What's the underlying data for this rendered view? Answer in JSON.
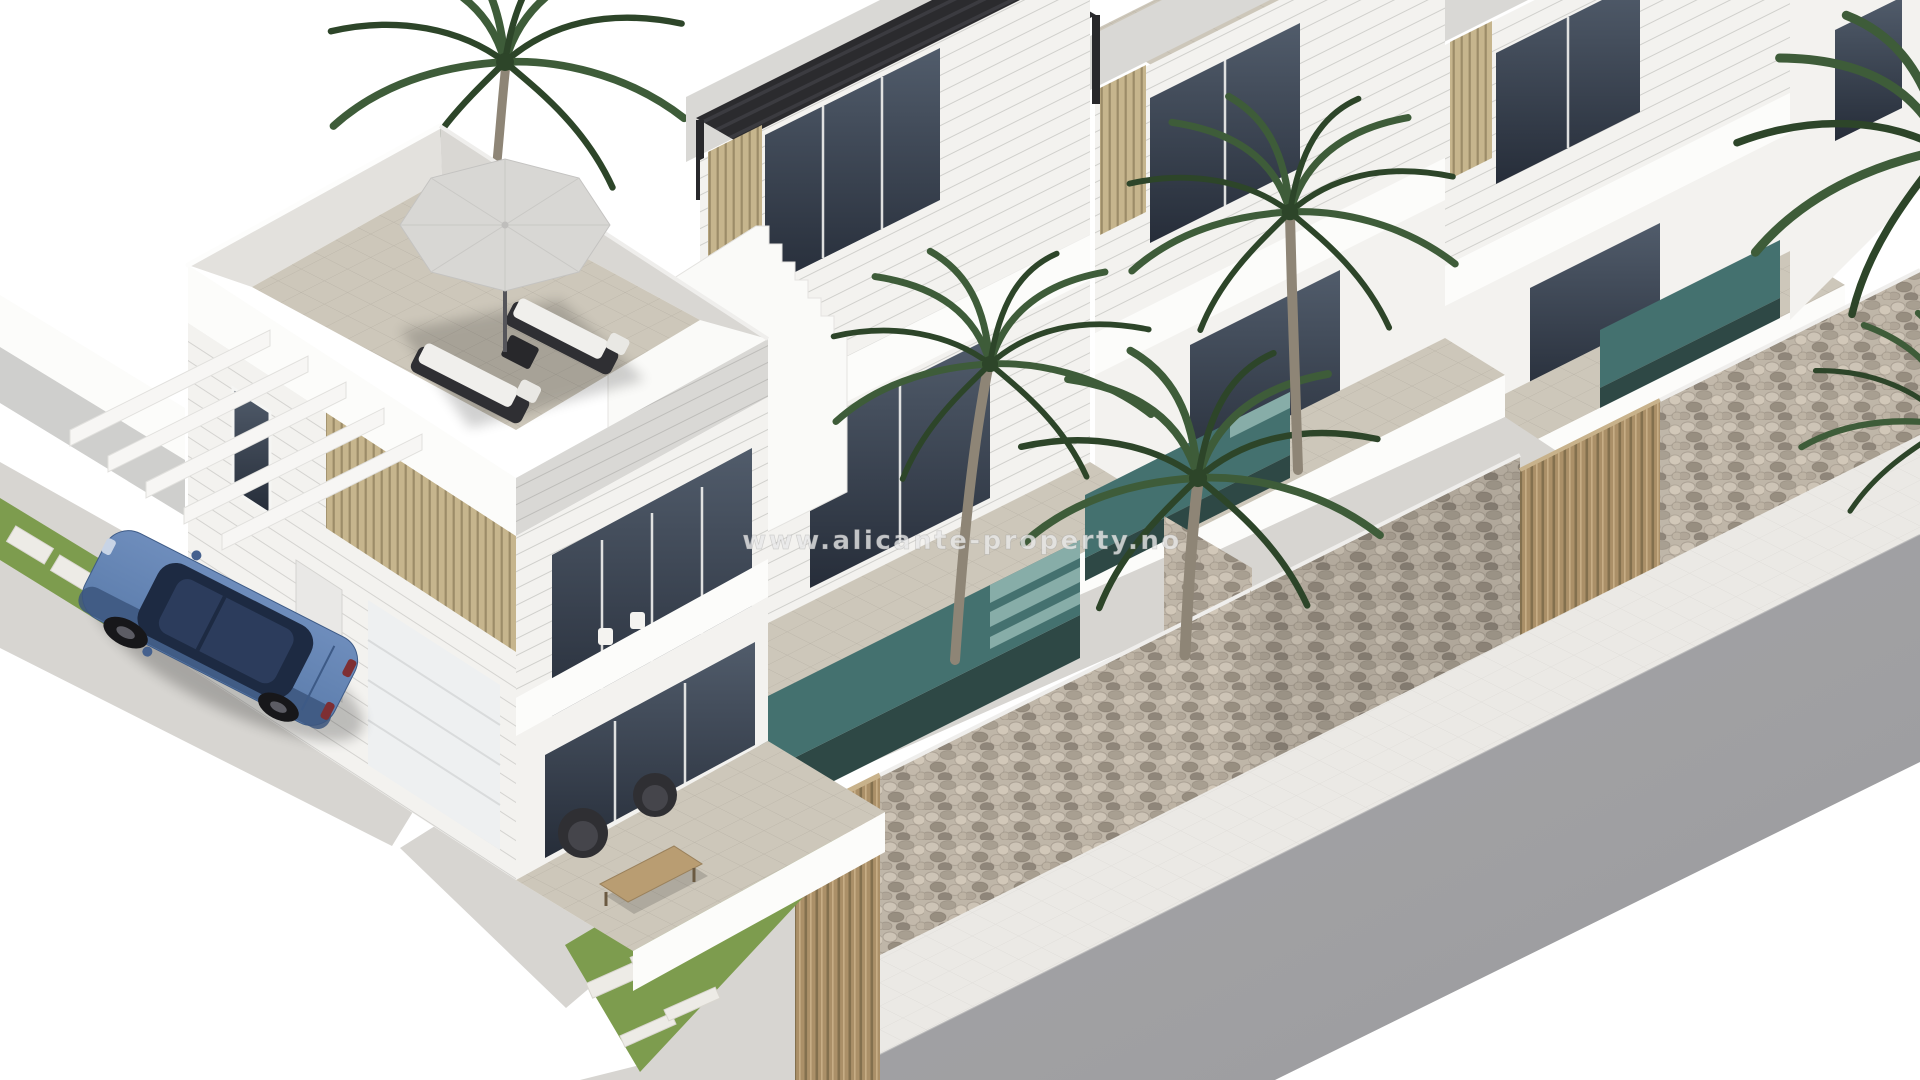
{
  "watermark": {
    "text": "www.alicante-property.no"
  },
  "palette": {
    "page-bg": "#ffffff",
    "white-wall": "#f3f2ef",
    "bright-wall": "#fcfcfa",
    "shaded-wall": "#e6e4e1",
    "roof-band": "#d9d8d5",
    "glass-top": "#515c6b",
    "glass-bottom": "#262d39",
    "wood-slat": "#c6b58d",
    "wood-slat-dark": "#9c8c68",
    "wood-gate": "#ab9068",
    "wood-gate-dark": "#83704e",
    "stone-light": "#bfb6a8",
    "grass": "#7d9c4e",
    "pool-teal": "#44716f",
    "pool-teal-light": "#87ada8",
    "pool-edge": "#2e4845",
    "pavement": "#d7d5d1",
    "sidewalk": "#ebe9e5",
    "road": "#a6a6a8",
    "road-dark": "#9b9b9e",
    "car-body": "#5b7cab",
    "car-roof": "#1f2c45",
    "pergola": "#2b2b2e",
    "parasol": "#d8d7d4",
    "palm-green": "#3e5c39",
    "palm-green-dark": "#2d4529",
    "palm-trunk": "#8e8576",
    "terrace-floor": "#cdc7ba",
    "watermark": "#e9e9e9"
  }
}
